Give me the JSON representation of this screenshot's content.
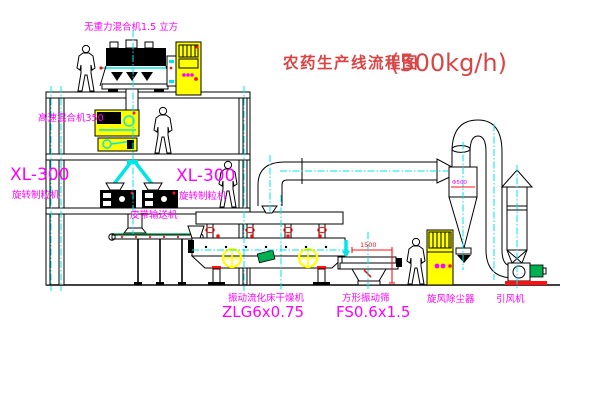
{
  "title": {
    "main": "农药生产线流程图",
    "capacity": "(500kg/h)"
  },
  "labels": {
    "gravity_mixer": "无重力混合机1.5 立方",
    "high_speed_mixer": "高速混合机350",
    "granulator_left": {
      "model": "XL-300",
      "name": "旋转制粒机"
    },
    "granulator_right": {
      "model": "XL-300",
      "name": "旋转制粒机"
    },
    "belt_conveyor": "皮带输送机",
    "dryer": {
      "name": "振动流化床干燥机",
      "model": "ZLG6x0.75"
    },
    "screen": {
      "name": "方形振动筛",
      "model": "FS0.6x1.5"
    },
    "cyclone": {
      "name": "旋风除尘器",
      "dia": "Φ500"
    },
    "fan": {
      "name": "引风机"
    },
    "dimension_1500": "1500"
  },
  "colors": {
    "black": "#000000",
    "cyan": "#00e5e5",
    "magenta": "#ff00ff",
    "yellow": "#ffff00",
    "red": "#ff1010",
    "green": "#00b050",
    "title_red": "#d94545"
  }
}
